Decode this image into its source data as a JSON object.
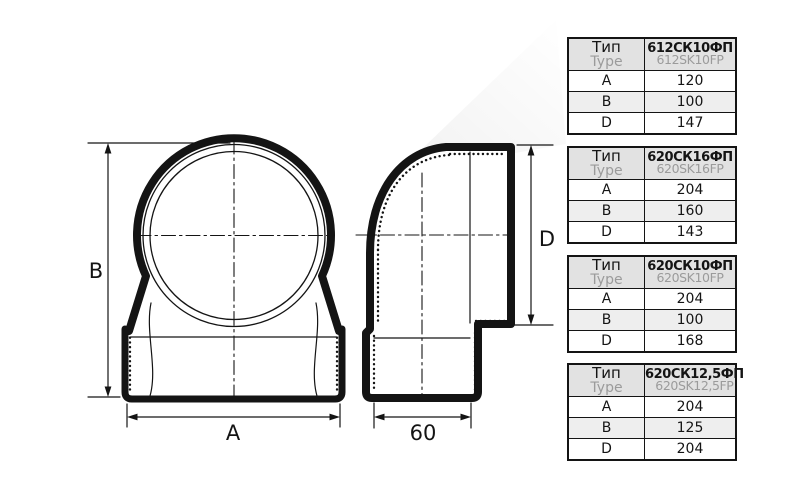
{
  "drawing": {
    "dim_a": "A",
    "dim_b": "B",
    "dim_d": "D",
    "dim_depth": "60"
  },
  "colors": {
    "line": "#141414",
    "table_header_bg": "#e2e2e2",
    "table_alt_row_bg": "#eeeeee",
    "muted_text": "#9b9b9b"
  },
  "tables": [
    {
      "type_label_ru": "Тип",
      "type_label_en": "Type",
      "code_ru": "612СК10ФП",
      "code_en": "612SK10FP",
      "rows": [
        {
          "label": "A",
          "value": "120"
        },
        {
          "label": "B",
          "value": "100"
        },
        {
          "label": "D",
          "value": "147"
        }
      ]
    },
    {
      "type_label_ru": "Тип",
      "type_label_en": "Type",
      "code_ru": "620СК16ФП",
      "code_en": "620SK16FP",
      "rows": [
        {
          "label": "A",
          "value": "204"
        },
        {
          "label": "B",
          "value": "160"
        },
        {
          "label": "D",
          "value": "143"
        }
      ]
    },
    {
      "type_label_ru": "Тип",
      "type_label_en": "Type",
      "code_ru": "620СК10ФП",
      "code_en": "620SK10FP",
      "rows": [
        {
          "label": "A",
          "value": "204"
        },
        {
          "label": "B",
          "value": "100"
        },
        {
          "label": "D",
          "value": "168"
        }
      ]
    },
    {
      "type_label_ru": "Тип",
      "type_label_en": "Type",
      "code_ru": "620СК12,5ФП",
      "code_en": "620SK12,5FP",
      "rows": [
        {
          "label": "A",
          "value": "204"
        },
        {
          "label": "B",
          "value": "125"
        },
        {
          "label": "D",
          "value": "204"
        }
      ]
    }
  ]
}
